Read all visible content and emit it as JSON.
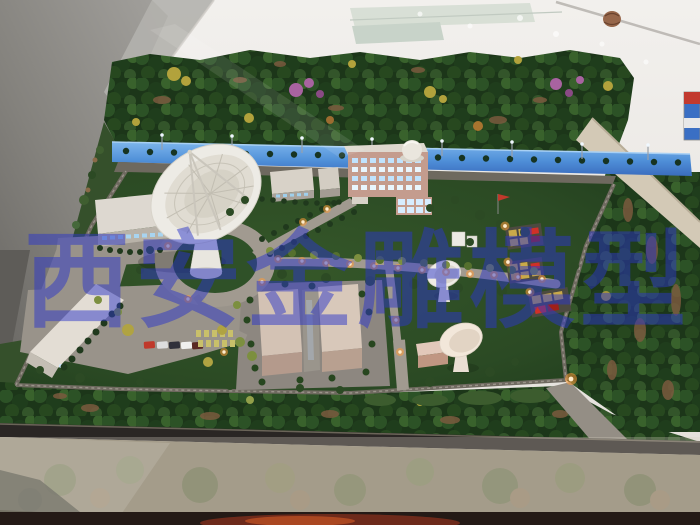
{
  "photo": {
    "subject": "Architectural scale model of a satellite ground-station compound displayed in a glass case",
    "watermark": {
      "text": "西安金雕模型",
      "chars": [
        "西",
        "安",
        "金",
        "雕",
        "模",
        "型"
      ],
      "color": "#2b35c8",
      "opacity": 0.5
    },
    "palette": {
      "lawn_green": "#2d4b27",
      "forest_green": "#1f3d1c",
      "illuminated_road_blue": "#4f8fd8",
      "pavement_gray": "#a19a90",
      "building_tan": "#c49c8e",
      "dish_white": "#edebe5",
      "lamp_glow_orange": "#ff9d3a",
      "case_frame_dark": "#2a2624",
      "room_floor_white": "#eceae6"
    }
  }
}
